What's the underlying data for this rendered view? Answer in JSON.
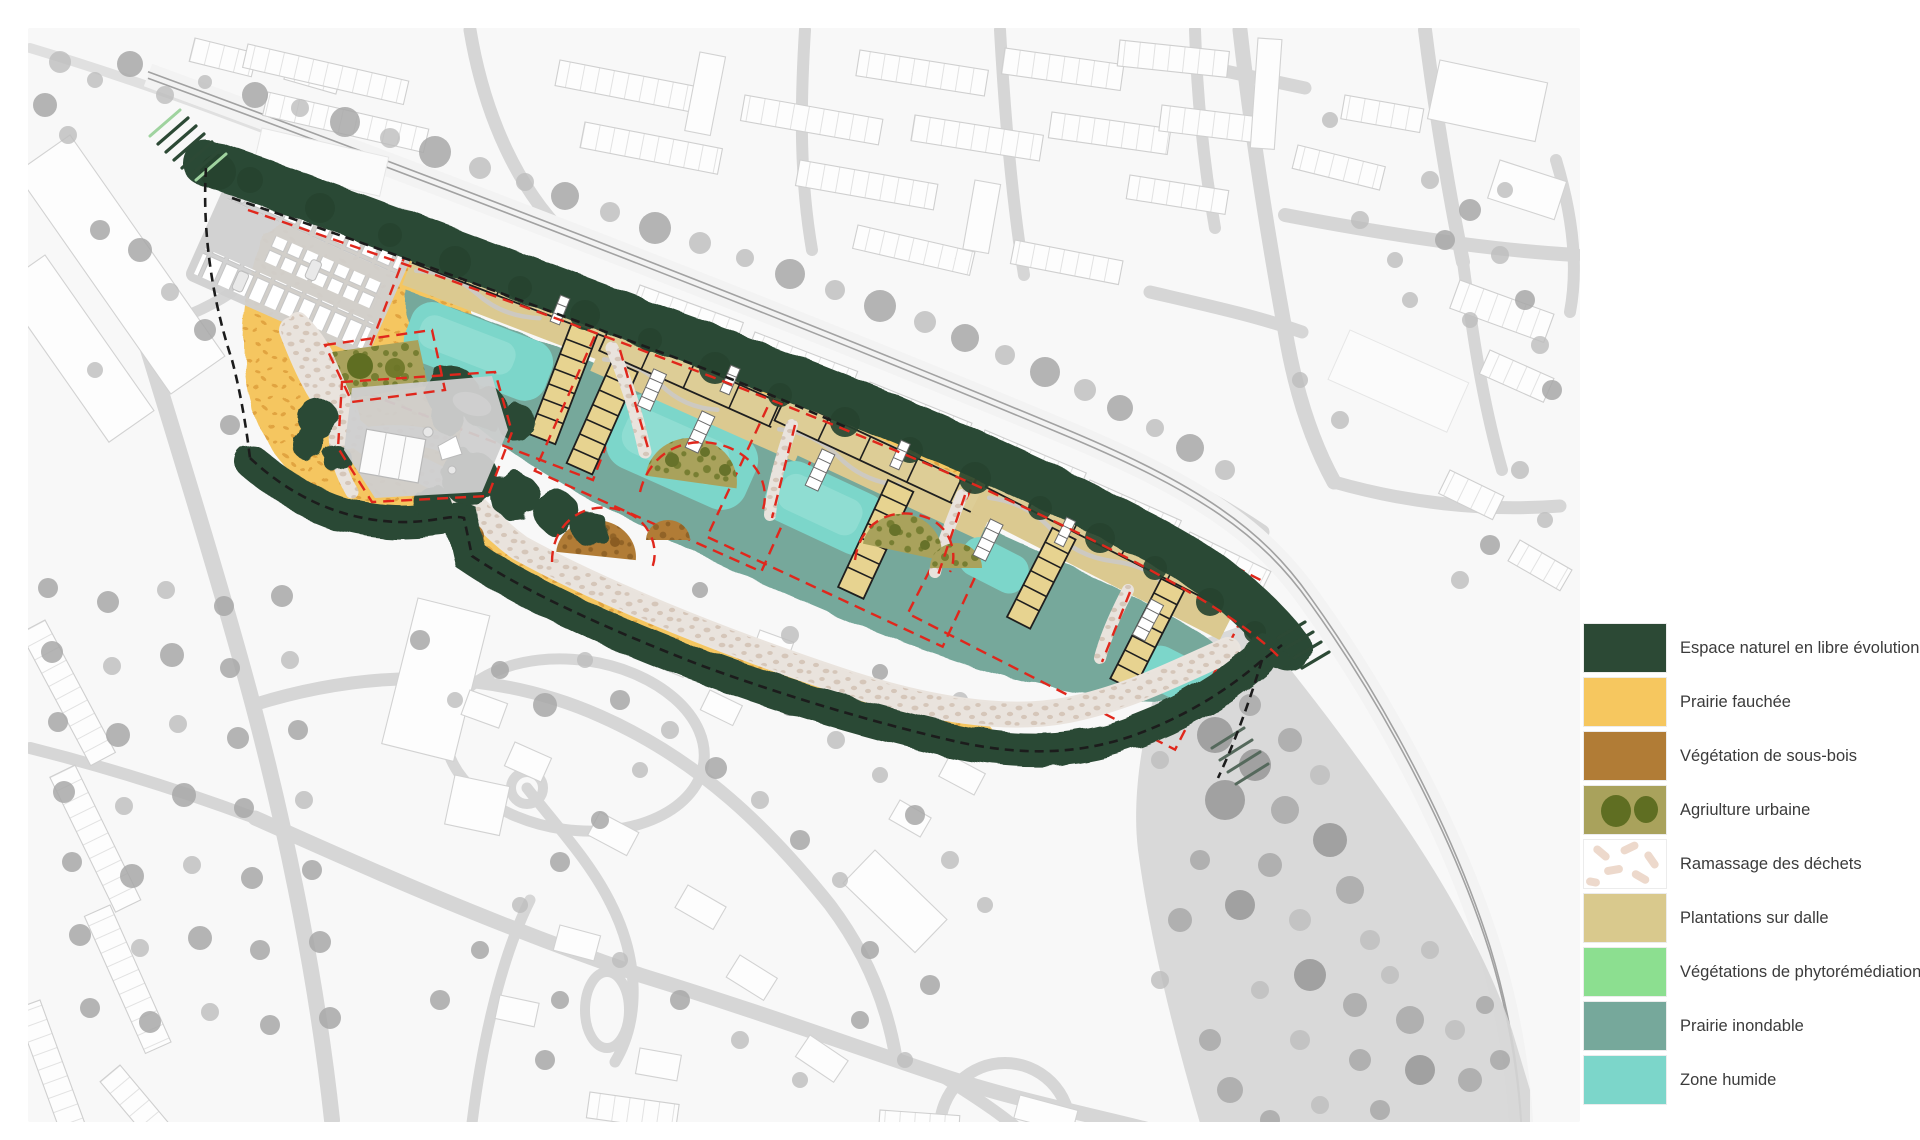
{
  "legend": {
    "items": [
      {
        "label": "Espace naturel en libre évolution",
        "color": "#2c4935",
        "swatch": "solid"
      },
      {
        "label": "Prairie fauchée",
        "color": "#f6c75f",
        "swatch": "solid"
      },
      {
        "label": "Végétation de sous-bois",
        "color": "#b17c36",
        "swatch": "solid"
      },
      {
        "label": "Agriulture urbaine",
        "color": "#a9a25c",
        "swatch": "dots",
        "dot_color": "#5f6e22"
      },
      {
        "label": "Ramassage des déchets",
        "color": "#ffffff",
        "swatch": "capsules",
        "pattern_color": "#edd9cc"
      },
      {
        "label": "Plantations sur dalle",
        "color": "#d9c98d",
        "swatch": "solid"
      },
      {
        "label": "Végétations de phytorémédiation",
        "color": "#8cdf90",
        "swatch": "solid"
      },
      {
        "label": "Prairie inondable",
        "color": "#76a89b",
        "swatch": "solid"
      },
      {
        "label": "Zone humide",
        "color": "#7cd6ca",
        "swatch": "solid"
      }
    ],
    "text_color": "#3b3b3b"
  },
  "map": {
    "palette": {
      "background": "#ffffff",
      "fabric": "#f8f8f8",
      "context_road": "#d6d6d6",
      "context_building": "#fdfdfd",
      "context_tree": "#a8a8a8",
      "railway_line": "#a2a2a2",
      "embankment": "#d5d5d5",
      "gravel_path": "#e9e3dd",
      "prairie_dots": "#dd9e3b",
      "plot_boundary_red": "#e0271c",
      "site_boundary_black": "#1c1c1c"
    }
  }
}
